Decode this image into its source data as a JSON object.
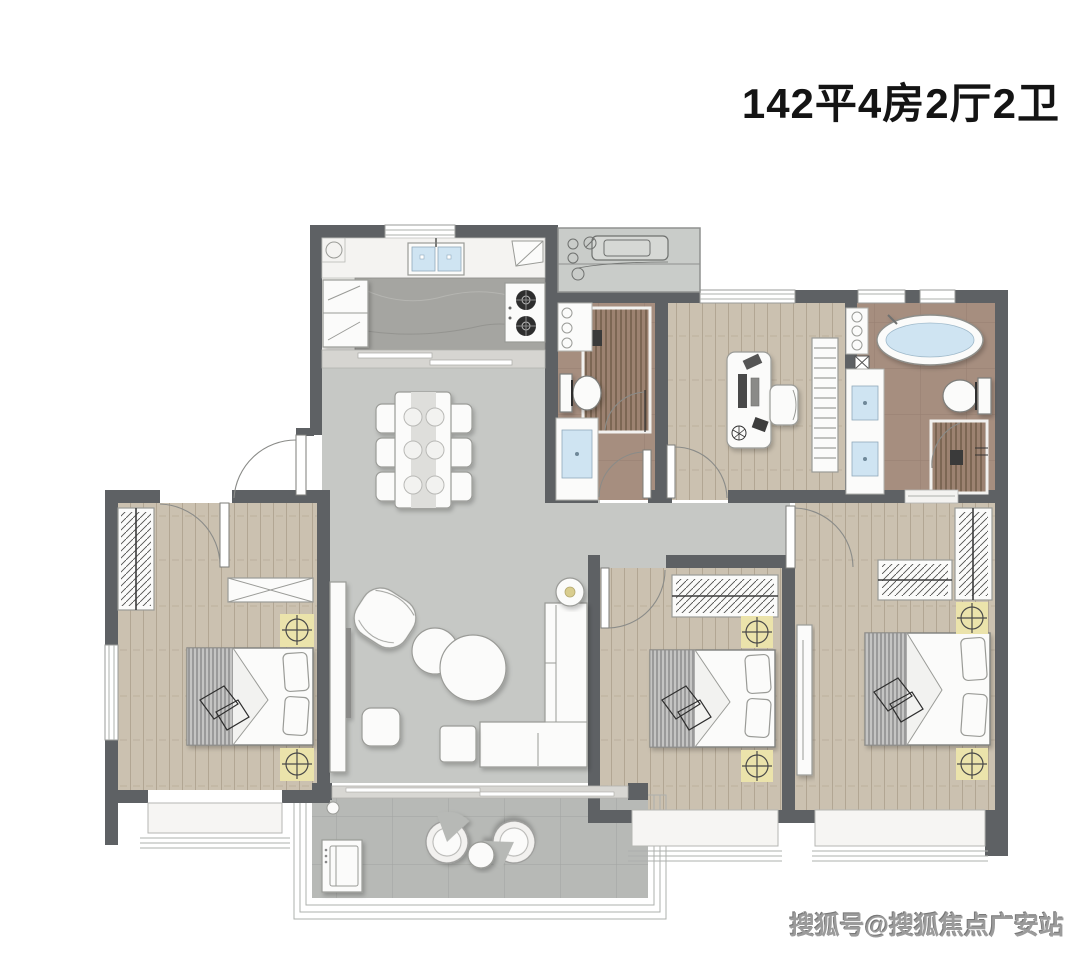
{
  "header": {
    "title": "142平4房2厅2卫"
  },
  "footer": {
    "watermark": "搜狐号@搜狐焦点广安站"
  },
  "colors": {
    "wall": "#5e6164",
    "wood_floor": "#cbc1b0",
    "marble_floor": "#c6c8c5",
    "bath_floor": "#a68e7f",
    "balcony_floor": "#b7b9b6",
    "kitchen_floor": "#f0efec",
    "accent_light_fixture": "#ebe3ab",
    "water_blue": "#cfe4f2",
    "title_text": "#141414",
    "watermark_text": "#9b9b9b"
  }
}
